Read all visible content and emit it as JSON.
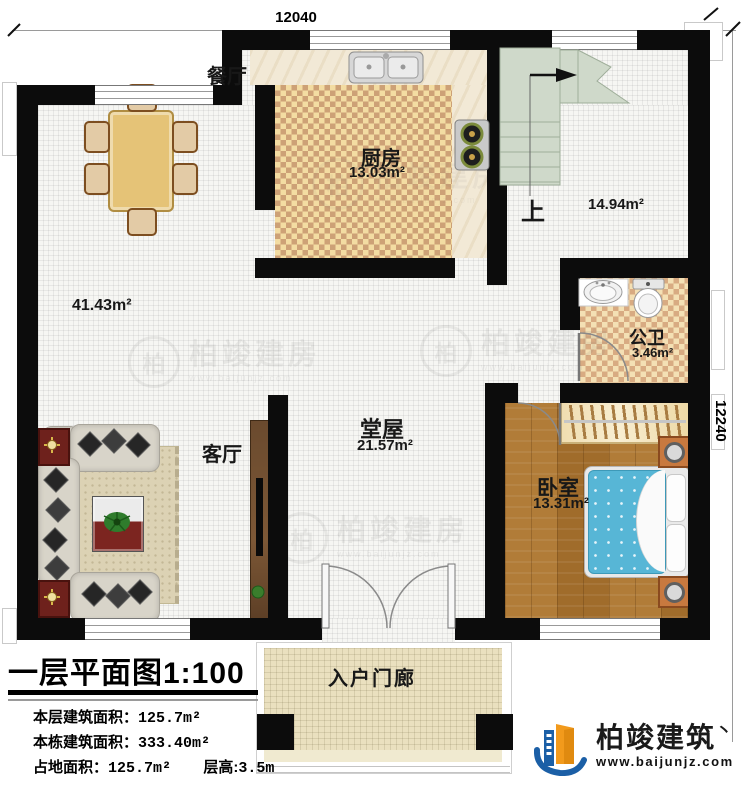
{
  "plan": {
    "dimensions": {
      "width_mm": "12040",
      "depth_mm": "12240"
    },
    "rooms": {
      "dining": {
        "label": "餐厅"
      },
      "kitchen": {
        "label": "厨房",
        "area": "13.03m²"
      },
      "stair_hall": {
        "up_label": "上",
        "area": "14.94m²"
      },
      "bathroom": {
        "label": "公卫",
        "area": "3.46m²"
      },
      "bedroom": {
        "label": "卧室",
        "area": "13.31m²"
      },
      "hall": {
        "label": "堂屋",
        "area": "21.57m²"
      },
      "living": {
        "label": "客厅"
      },
      "open_area": {
        "area": "41.43m²"
      },
      "porch": {
        "label": "入户门廊"
      }
    }
  },
  "title_block": {
    "title": "一层平面图",
    "scale": "1:100",
    "stats": [
      {
        "label": "本层建筑面积：",
        "value": "125.7m²"
      },
      {
        "label": "本栋建筑面积：",
        "value": "333.40m²"
      },
      {
        "label": "占地面积：",
        "value": "125.7m²"
      }
    ],
    "floor_height": {
      "label": "层高:",
      "value": "3.5m"
    }
  },
  "branding": {
    "company": "柏竣建筑",
    "tick": "丶",
    "website": "www.baijunjz.com",
    "colors": {
      "blue": "#1b5fa6",
      "orange": "#f29a1c"
    }
  },
  "watermark": {
    "initial": "柏",
    "text": "柏竣建房",
    "subtext": "www.baijunjz.com"
  }
}
